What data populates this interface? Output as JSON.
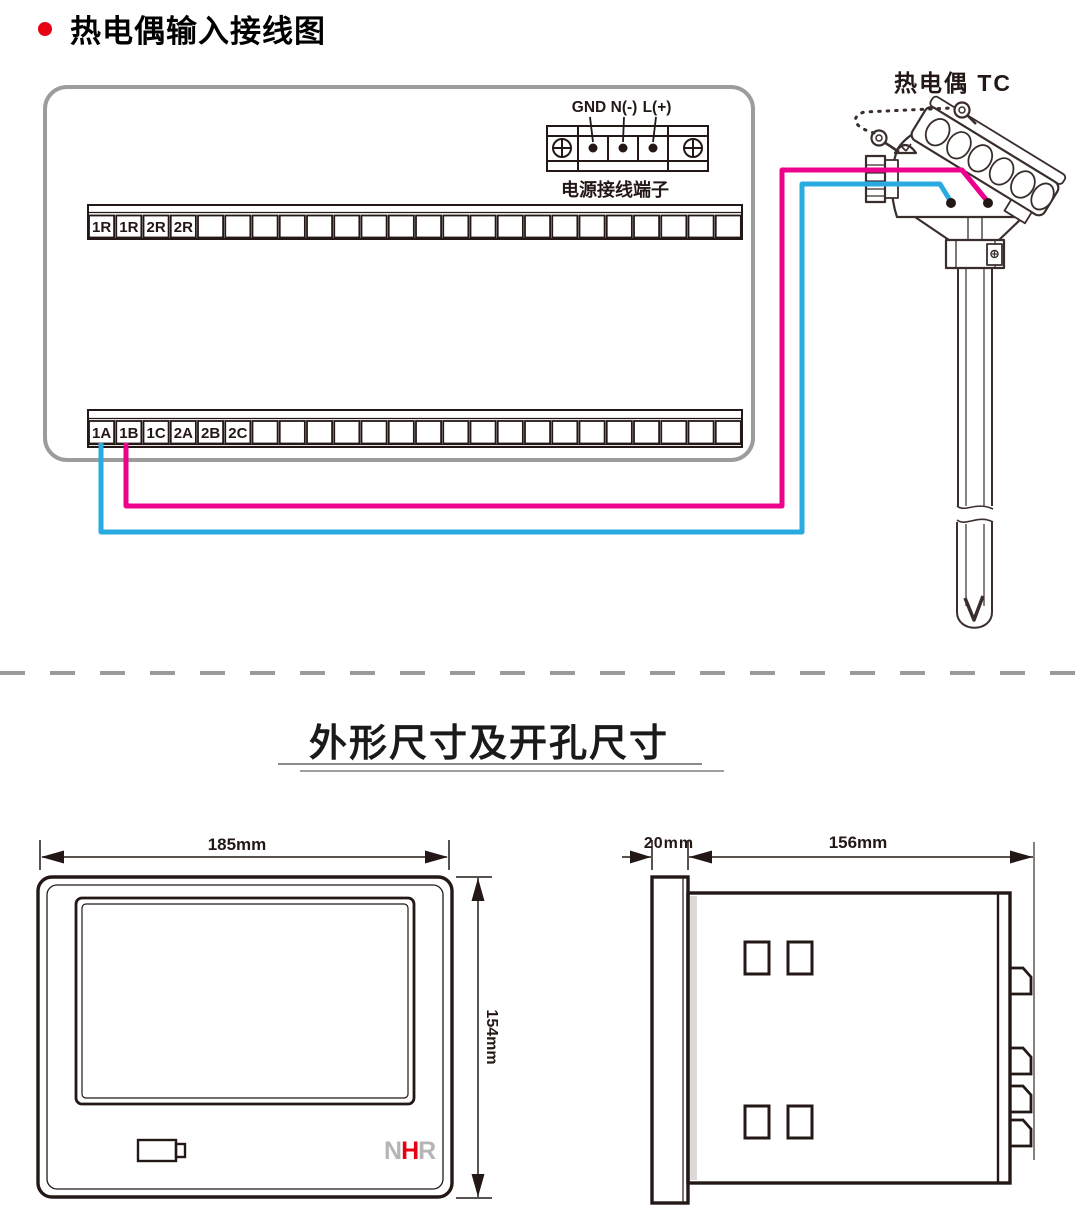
{
  "header": {
    "title": "热电偶输入接线图",
    "bullet_color": "#e60012"
  },
  "wiring": {
    "power_terminal": {
      "labels": [
        "GND",
        "N(-)",
        "L(+)"
      ],
      "caption": "电源接线端子"
    },
    "top_strip": {
      "cell_count": 24,
      "labels": [
        "1R",
        "1R",
        "2R",
        "2R"
      ]
    },
    "bottom_strip": {
      "cell_count": 24,
      "labels": [
        "1A",
        "1B",
        "1C",
        "2A",
        "2B",
        "2C"
      ]
    },
    "thermocouple": {
      "label": "热电偶 TC"
    },
    "wire_colors": {
      "positive": "#ec008c",
      "negative": "#29abe2"
    }
  },
  "dimensions": {
    "section_title": "外形尺寸及开孔尺寸",
    "front_view": {
      "width_label": "185mm",
      "height_label": "154mm",
      "logo": {
        "letters": [
          {
            "char": "N",
            "color": "#b5b5b6"
          },
          {
            "char": "H",
            "color": "#e60012"
          },
          {
            "char": "R",
            "color": "#b5b5b6"
          }
        ]
      }
    },
    "side_view": {
      "depth_label": "20mm",
      "length_label": "156mm"
    }
  }
}
